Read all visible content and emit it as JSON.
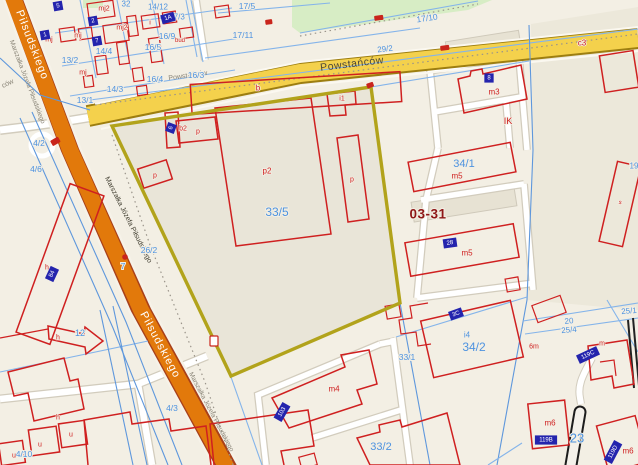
{
  "section_label": "03-31",
  "streets": {
    "pilsudskiego": "Piłsudskiego",
    "powstancow": "Powstańców",
    "marszalka": "Marszałka Józefa Piłsudskiego"
  },
  "main_parcel": "33/5",
  "colors": {
    "background": "#f3efe4",
    "parcel_inner": "#e9e5d8",
    "parcel_east": "#ece8da",
    "green_area": "#d7edc5",
    "road_orange": "#e2790b",
    "road_orange_casing": "#a8401a",
    "road_yellow": "#f4d14c",
    "road_yellow_casing": "#9d7e10",
    "road_white": "#ffffff",
    "highlight_boundary": "#b2a31b",
    "building_line": "#cf2020",
    "parcel_line": "#84b4ea",
    "label_blue": "#4e93e0",
    "label_red": "#cf2020",
    "section_red": "#8e1616",
    "address_box": "#2424ad",
    "path_black": "#1c1c1c"
  },
  "labels": [
    {
      "t": "Marszałka Józefa Piłsudskiego",
      "x": 27,
      "y": 82,
      "c": "gray",
      "s": 6.5,
      "r": 69,
      "n": "street-label"
    },
    {
      "t": "Marszałka Józefa Piłsudskiego",
      "x": 128,
      "y": 220,
      "c": "dark",
      "s": 7,
      "r": 63,
      "n": "street-label"
    },
    {
      "t": "Marszałka Józefa Piłsudskiego",
      "x": 211,
      "y": 412,
      "c": "gray",
      "s": 6.5,
      "r": 62,
      "n": "street-label"
    },
    {
      "t": "Powstańców",
      "x": 188,
      "y": 76,
      "c": "gray",
      "s": 7,
      "r": -8,
      "n": "street-label"
    },
    {
      "t": "ców",
      "x": 8,
      "y": 84,
      "c": "gray",
      "s": 7,
      "r": -25,
      "n": "street-label"
    },
    {
      "t": "17/5",
      "x": 247,
      "y": 6,
      "c": "blue",
      "s": 8.5,
      "r": 0,
      "n": "parcel-label"
    },
    {
      "t": "17/11",
      "x": 243,
      "y": 35,
      "c": "blue",
      "s": 8.5,
      "r": 0,
      "n": "parcel-label"
    },
    {
      "t": "17/3",
      "x": 177,
      "y": 17,
      "c": "blue",
      "s": 8,
      "r": 0,
      "n": "parcel-label"
    },
    {
      "t": "14/12",
      "x": 158,
      "y": 7,
      "c": "blue",
      "s": 8,
      "r": 0,
      "n": "parcel-label"
    },
    {
      "t": "32",
      "x": 126,
      "y": 4,
      "c": "blue",
      "s": 8,
      "r": 0,
      "n": "parcel-label"
    },
    {
      "t": "16/9",
      "x": 167,
      "y": 36,
      "c": "blue",
      "s": 8.5,
      "r": 0,
      "n": "parcel-label"
    },
    {
      "t": "16/5",
      "x": 153,
      "y": 47,
      "c": "blue",
      "s": 8.5,
      "r": 0,
      "n": "parcel-label"
    },
    {
      "t": "16/4",
      "x": 155,
      "y": 79,
      "c": "blue",
      "s": 8.5,
      "r": 0,
      "n": "parcel-label"
    },
    {
      "t": "16/3",
      "x": 196,
      "y": 75,
      "c": "blue",
      "s": 8.5,
      "r": 0,
      "n": "parcel-label"
    },
    {
      "t": "14/4",
      "x": 104,
      "y": 51,
      "c": "blue",
      "s": 8.5,
      "r": 0,
      "n": "parcel-label"
    },
    {
      "t": "14/3",
      "x": 115,
      "y": 89,
      "c": "blue",
      "s": 8.5,
      "r": 0,
      "n": "parcel-label"
    },
    {
      "t": "13/2",
      "x": 70,
      "y": 60,
      "c": "blue",
      "s": 8.5,
      "r": 0,
      "n": "parcel-label"
    },
    {
      "t": "13/1",
      "x": 85,
      "y": 100,
      "c": "blue",
      "s": 8.5,
      "r": 0,
      "n": "parcel-label"
    },
    {
      "t": "4/2",
      "x": 39,
      "y": 143,
      "c": "blue",
      "s": 8.5,
      "r": 0,
      "n": "parcel-label"
    },
    {
      "t": "4/6",
      "x": 36,
      "y": 169,
      "c": "blue",
      "s": 8.5,
      "r": 0,
      "n": "parcel-label"
    },
    {
      "t": "29/2",
      "x": 385,
      "y": 49,
      "c": "blue",
      "s": 8,
      "r": -7,
      "n": "parcel-label"
    },
    {
      "t": "17/10",
      "x": 427,
      "y": 18,
      "c": "blue",
      "s": 8.5,
      "r": -8,
      "n": "parcel-label"
    },
    {
      "t": "26/2",
      "x": 149,
      "y": 250,
      "c": "blue",
      "s": 8.5,
      "r": 0,
      "n": "parcel-label"
    },
    {
      "t": "7",
      "x": 123,
      "y": 266,
      "c": "blue",
      "s": 8.5,
      "r": 0,
      "n": "parcel-label"
    },
    {
      "t": "12",
      "x": 80,
      "y": 333,
      "c": "blue",
      "s": 9,
      "r": 0,
      "n": "parcel-label"
    },
    {
      "t": "4/3",
      "x": 172,
      "y": 408,
      "c": "blue",
      "s": 8.5,
      "r": 0,
      "n": "parcel-label"
    },
    {
      "t": "4/10",
      "x": 24,
      "y": 454,
      "c": "blue",
      "s": 8.5,
      "r": 0,
      "n": "parcel-label"
    },
    {
      "t": "34/1",
      "x": 464,
      "y": 164,
      "c": "blue",
      "s": 11,
      "r": 0,
      "n": "parcel-label"
    },
    {
      "t": "33/1",
      "x": 407,
      "y": 357,
      "c": "blue",
      "s": 8.5,
      "r": 0,
      "n": "parcel-label"
    },
    {
      "t": "33/2",
      "x": 381,
      "y": 447,
      "c": "blue",
      "s": 11,
      "r": 0,
      "n": "parcel-label"
    },
    {
      "t": "34/2",
      "x": 474,
      "y": 347,
      "c": "blue",
      "s": 12,
      "r": 0,
      "n": "parcel-label"
    },
    {
      "t": "i4",
      "x": 467,
      "y": 335,
      "c": "blue",
      "s": 8,
      "r": 0,
      "n": "parcel-label"
    },
    {
      "t": "23",
      "x": 577,
      "y": 438,
      "c": "blue",
      "s": 13,
      "r": 0,
      "n": "parcel-label"
    },
    {
      "t": "20",
      "x": 569,
      "y": 321,
      "c": "blue",
      "s": 8,
      "r": -5,
      "n": "parcel-label"
    },
    {
      "t": "25/4",
      "x": 569,
      "y": 330,
      "c": "blue",
      "s": 8,
      "r": -5,
      "n": "parcel-label"
    },
    {
      "t": "25/1",
      "x": 629,
      "y": 311,
      "c": "blue",
      "s": 8,
      "r": -5,
      "n": "parcel-label"
    },
    {
      "t": "19",
      "x": 634,
      "y": 166,
      "c": "blue",
      "s": 8,
      "r": 0,
      "n": "parcel-label"
    },
    {
      "t": "mj2",
      "x": 104,
      "y": 9,
      "c": "red",
      "s": 7,
      "r": 0,
      "n": "building-label"
    },
    {
      "t": "mj2",
      "x": 122,
      "y": 28,
      "c": "red",
      "s": 7,
      "r": 0,
      "n": "building-label"
    },
    {
      "t": "mj",
      "x": 49,
      "y": 40,
      "c": "red",
      "s": 7,
      "r": 0,
      "n": "building-label"
    },
    {
      "t": "mj",
      "x": 78,
      "y": 36,
      "c": "red",
      "s": 7,
      "r": 0,
      "n": "building-label"
    },
    {
      "t": "mj",
      "x": 83,
      "y": 73,
      "c": "red",
      "s": 7,
      "r": 0,
      "n": "building-label"
    },
    {
      "t": "i",
      "x": 150,
      "y": 23,
      "c": "red",
      "s": 7,
      "r": 0,
      "n": "building-label"
    },
    {
      "t": "bud",
      "x": 180,
      "y": 41,
      "c": "red",
      "s": 6,
      "r": 0,
      "n": "building-label"
    },
    {
      "t": "b",
      "x": 258,
      "y": 88,
      "c": "red",
      "s": 8,
      "r": 0,
      "n": "building-label"
    },
    {
      "t": "b2",
      "x": 183,
      "y": 129,
      "c": "red",
      "s": 7,
      "r": 0,
      "n": "building-label"
    },
    {
      "t": "p",
      "x": 198,
      "y": 132,
      "c": "red",
      "s": 7,
      "r": 0,
      "n": "building-label"
    },
    {
      "t": "p2",
      "x": 267,
      "y": 171,
      "c": "red",
      "s": 8,
      "r": 0,
      "n": "building-label"
    },
    {
      "t": "p",
      "x": 352,
      "y": 180,
      "c": "red",
      "s": 7,
      "r": 0,
      "n": "building-label"
    },
    {
      "t": "p",
      "x": 155,
      "y": 176,
      "c": "red",
      "s": 7,
      "r": 0,
      "n": "building-label"
    },
    {
      "t": "i1",
      "x": 342,
      "y": 99,
      "c": "red",
      "s": 7,
      "r": 0,
      "n": "building-label"
    },
    {
      "t": "m3",
      "x": 494,
      "y": 92,
      "c": "red",
      "s": 8,
      "r": 0,
      "n": "building-label"
    },
    {
      "t": "m5",
      "x": 457,
      "y": 176,
      "c": "red",
      "s": 8,
      "r": 0,
      "n": "building-label"
    },
    {
      "t": "m5",
      "x": 467,
      "y": 253,
      "c": "red",
      "s": 8,
      "r": 0,
      "n": "building-label"
    },
    {
      "t": "m4",
      "x": 334,
      "y": 389,
      "c": "red",
      "s": 8,
      "r": 0,
      "n": "building-label"
    },
    {
      "t": "m6",
      "x": 550,
      "y": 423,
      "c": "red",
      "s": 8,
      "r": 0,
      "n": "building-label"
    },
    {
      "t": "m6",
      "x": 628,
      "y": 451,
      "c": "red",
      "s": 8,
      "r": 0,
      "n": "building-label"
    },
    {
      "t": "m",
      "x": 602,
      "y": 344,
      "c": "red",
      "s": 7,
      "r": 0,
      "n": "building-label"
    },
    {
      "t": "s",
      "x": 620,
      "y": 203,
      "c": "red",
      "s": 6,
      "r": 13,
      "n": "building-label"
    },
    {
      "t": "c3",
      "x": 582,
      "y": 43,
      "c": "red",
      "s": 8,
      "r": 0,
      "n": "building-label"
    },
    {
      "t": "6m",
      "x": 534,
      "y": 347,
      "c": "red",
      "s": 7,
      "r": 0,
      "n": "building-label"
    },
    {
      "t": "h",
      "x": 47,
      "y": 268,
      "c": "red",
      "s": 7,
      "r": 0,
      "n": "building-label"
    },
    {
      "t": "h",
      "x": 58,
      "y": 338,
      "c": "red",
      "s": 7,
      "r": 0,
      "n": "building-label"
    },
    {
      "t": "h",
      "x": 58,
      "y": 418,
      "c": "red",
      "s": 7,
      "r": 0,
      "n": "building-label"
    },
    {
      "t": "u",
      "x": 40,
      "y": 445,
      "c": "red",
      "s": 7,
      "r": 0,
      "n": "building-label"
    },
    {
      "t": "u",
      "x": 71,
      "y": 435,
      "c": "red",
      "s": 7,
      "r": 0,
      "n": "building-label"
    },
    {
      "t": "u",
      "x": 14,
      "y": 456,
      "c": "red",
      "s": 7,
      "r": 0,
      "n": "building-label"
    },
    {
      "t": "IK",
      "x": 508,
      "y": 121,
      "c": "red",
      "s": 9,
      "r": 0,
      "n": "utility-symbol-label"
    }
  ],
  "address_boxes": [
    {
      "t": "84",
      "x": 52,
      "y": 274,
      "r": -65
    },
    {
      "t": "6",
      "x": 171,
      "y": 128,
      "r": -70
    },
    {
      "t": "8",
      "x": 489,
      "y": 78,
      "r": 0
    },
    {
      "t": "28",
      "x": 450,
      "y": 243,
      "r": -8
    },
    {
      "t": "3C",
      "x": 456,
      "y": 314,
      "r": -20
    },
    {
      "t": "119C",
      "x": 588,
      "y": 355,
      "r": -25
    },
    {
      "t": "119B",
      "x": 546,
      "y": 440,
      "r": 0
    },
    {
      "t": "119D",
      "x": 613,
      "y": 452,
      "r": -62
    },
    {
      "t": "103",
      "x": 282,
      "y": 412,
      "r": -60
    },
    {
      "t": "1A",
      "x": 168,
      "y": 18,
      "r": -15
    },
    {
      "t": "5",
      "x": 58,
      "y": 6,
      "r": -10
    },
    {
      "t": "1",
      "x": 45,
      "y": 35,
      "r": -10
    },
    {
      "t": "7",
      "x": 97,
      "y": 41,
      "r": -10
    },
    {
      "t": "2",
      "x": 93,
      "y": 21,
      "r": -10
    }
  ],
  "markers": [
    {
      "sh": "rect",
      "x": 374,
      "y": 16,
      "w": 9,
      "h": 5,
      "r": -8
    },
    {
      "sh": "rect",
      "x": 265,
      "y": 20,
      "w": 7,
      "h": 5,
      "r": -8
    },
    {
      "sh": "rect",
      "x": 440,
      "y": 46,
      "w": 9,
      "h": 5,
      "r": -8
    },
    {
      "sh": "outline",
      "x": 210,
      "y": 336,
      "w": 8,
      "h": 10,
      "r": 0
    },
    {
      "sh": "dot",
      "x": 125,
      "y": 257,
      "rad": 2.8
    },
    {
      "sh": "rect",
      "x": 50,
      "y": 141,
      "w": 9,
      "h": 6,
      "r": -30
    },
    {
      "sh": "rect",
      "x": 366,
      "y": 84,
      "w": 7,
      "h": 5,
      "r": -20
    }
  ]
}
